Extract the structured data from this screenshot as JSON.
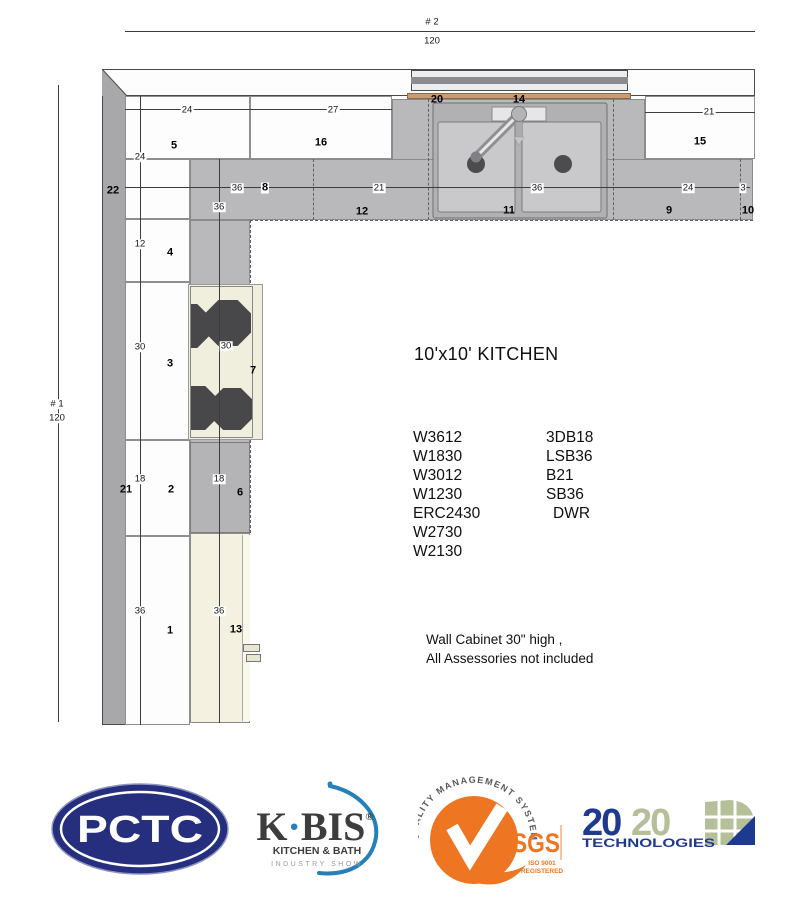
{
  "plan": {
    "overall_dims": {
      "top": {
        "id": "# 2",
        "value": "120"
      },
      "left": {
        "id": "# 1",
        "value": "120"
      }
    },
    "dim_labels": [
      {
        "t": "24",
        "x": 187,
        "y": 110
      },
      {
        "t": "27",
        "x": 333,
        "y": 110
      },
      {
        "t": "21",
        "x": 709,
        "y": 112
      },
      {
        "t": "36",
        "x": 237,
        "y": 188
      },
      {
        "t": "21",
        "x": 379,
        "y": 188
      },
      {
        "t": "36",
        "x": 537,
        "y": 188
      },
      {
        "t": "24",
        "x": 688,
        "y": 188
      },
      {
        "t": "3",
        "x": 743,
        "y": 188
      },
      {
        "t": "24",
        "x": 140,
        "y": 157
      },
      {
        "t": "12",
        "x": 140,
        "y": 244
      },
      {
        "t": "30",
        "x": 140,
        "y": 347
      },
      {
        "t": "18",
        "x": 140,
        "y": 479
      },
      {
        "t": "36",
        "x": 140,
        "y": 611
      },
      {
        "t": "36",
        "x": 219,
        "y": 207
      },
      {
        "t": "30",
        "x": 226,
        "y": 346
      },
      {
        "t": "18",
        "x": 219,
        "y": 479
      },
      {
        "t": "36",
        "x": 219,
        "y": 611
      }
    ],
    "item_labels": [
      {
        "t": "5",
        "x": 174,
        "y": 146
      },
      {
        "t": "16",
        "x": 321,
        "y": 143
      },
      {
        "t": "15",
        "x": 700,
        "y": 142
      },
      {
        "t": "20",
        "x": 437,
        "y": 100
      },
      {
        "t": "14",
        "x": 519,
        "y": 100
      },
      {
        "t": "8",
        "x": 265,
        "y": 188,
        "chip": true
      },
      {
        "t": "12",
        "x": 362,
        "y": 212
      },
      {
        "t": "11",
        "x": 509,
        "y": 211
      },
      {
        "t": "9",
        "x": 669,
        "y": 211
      },
      {
        "t": "10",
        "x": 748,
        "y": 211
      },
      {
        "t": "22",
        "x": 113,
        "y": 191
      },
      {
        "t": "4",
        "x": 170,
        "y": 253
      },
      {
        "t": "3",
        "x": 170,
        "y": 364
      },
      {
        "t": "7",
        "x": 253,
        "y": 371
      },
      {
        "t": "2",
        "x": 171,
        "y": 490
      },
      {
        "t": "6",
        "x": 240,
        "y": 493
      },
      {
        "t": "21",
        "x": 126,
        "y": 490
      },
      {
        "t": "1",
        "x": 170,
        "y": 631
      },
      {
        "t": "13",
        "x": 236,
        "y": 630
      }
    ]
  },
  "info": {
    "title": "10'x10' KITCHEN",
    "items_col1": [
      "W3612",
      "W1830",
      "W3012",
      "W1230",
      "ERC2430",
      "W2730",
      "W2130"
    ],
    "items_col2": [
      "3DB18",
      "LSB36",
      "B21",
      "SB36",
      "DWR"
    ],
    "note_line1": "Wall Cabinet 30\" high ,",
    "note_line2": "All Assessories not included"
  },
  "logos": {
    "pctc": {
      "text": "PCTC",
      "color": "#252f7d"
    },
    "kbis": {
      "k": "K",
      "dot": "·",
      "bis": "BIS",
      "registered": "®",
      "subtitle": "KITCHEN & BATH",
      "tagline": "INDUSTRY SHOW",
      "accent": "#2580ba",
      "text_color": "#3d3d3d"
    },
    "sgs": {
      "arc_text": "QUALITY MANAGEMENT SYSTEM",
      "name": "SGS",
      "iso": "ISO 9001",
      "registered": "REGISTERED",
      "color": "#ee7623"
    },
    "t2020": {
      "num1": "20",
      "num2": "20",
      "name": "TECHNOLOGIES",
      "navy": "#1e3a8f",
      "green": "#b5bf9a"
    }
  }
}
